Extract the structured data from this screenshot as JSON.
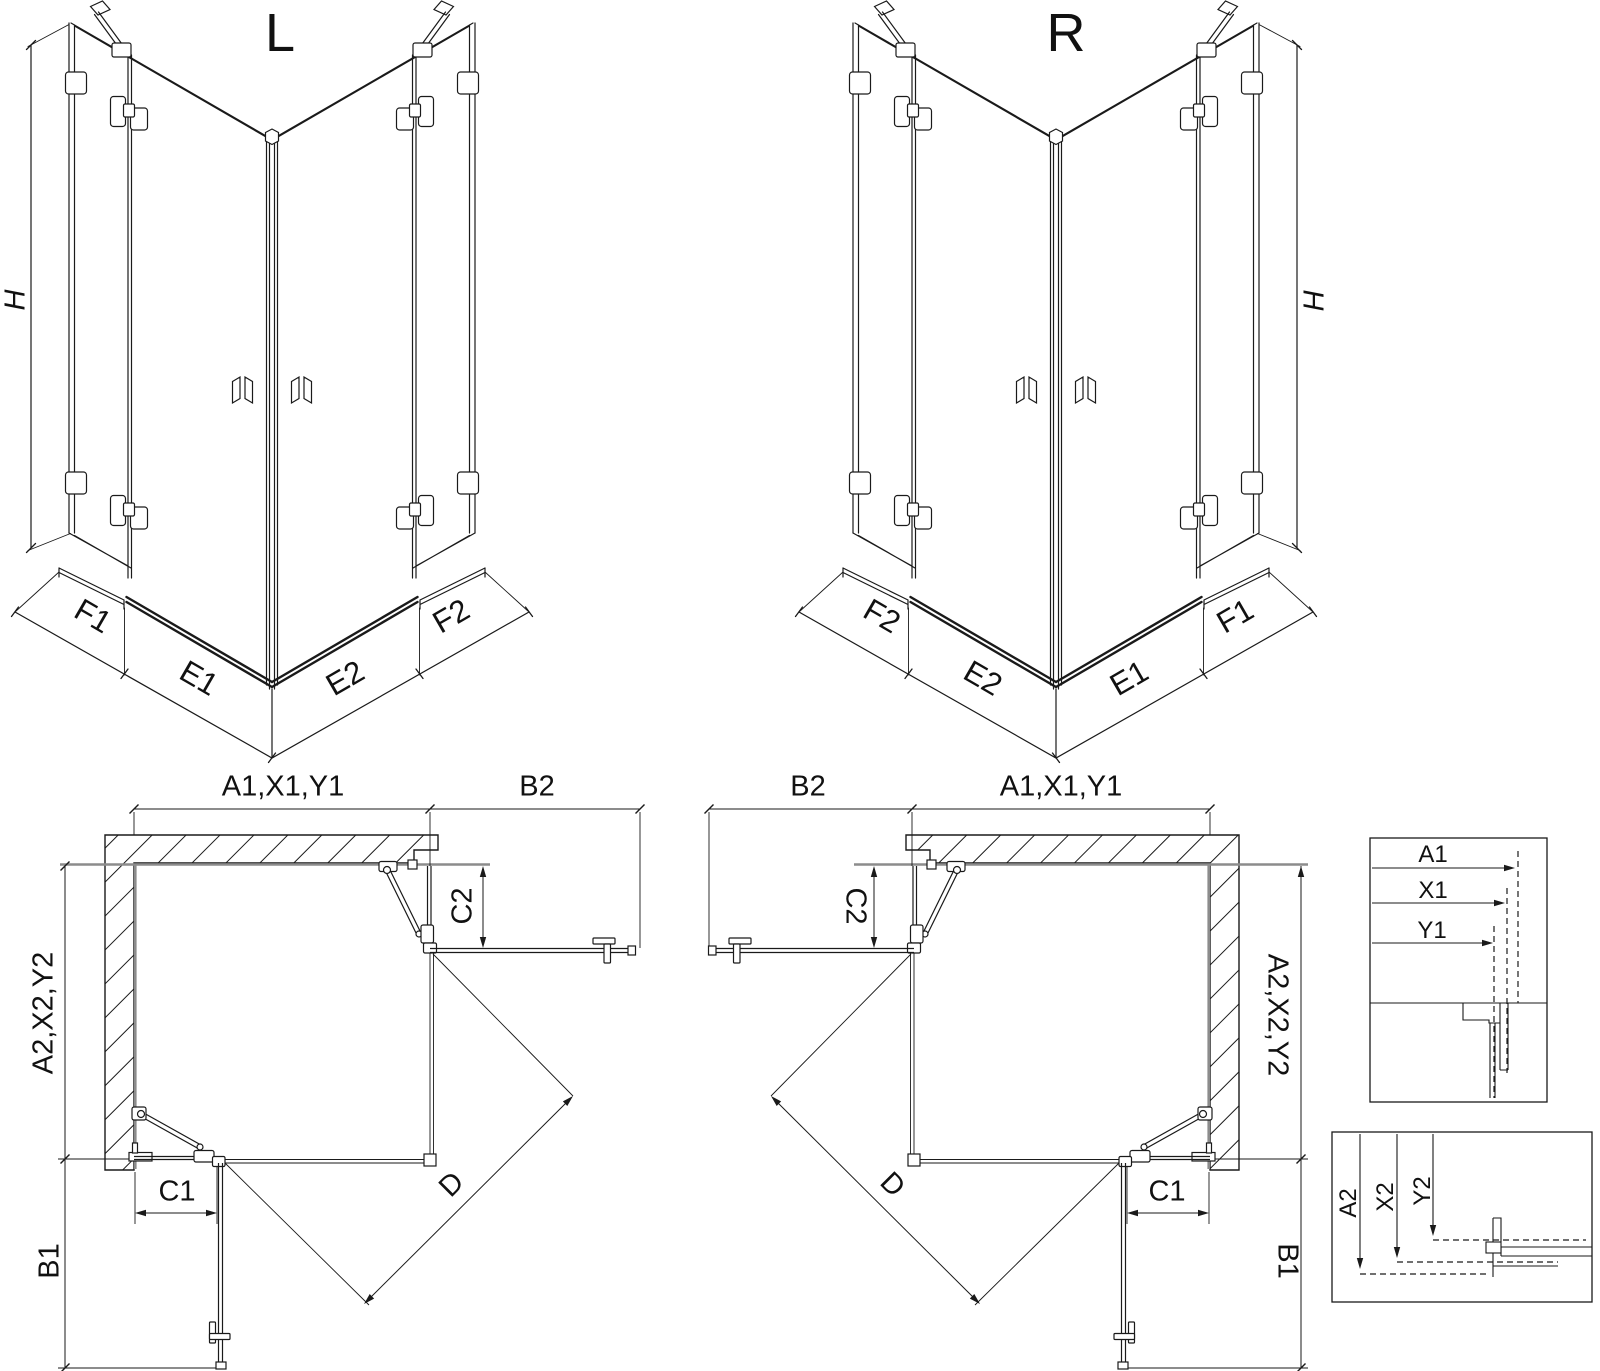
{
  "iso_left": {
    "title": "L",
    "height_dim": "H",
    "seg_front_left": "F1",
    "seg_bottom_left": "E1",
    "seg_bottom_right": "E2",
    "seg_front_right": "F2"
  },
  "iso_right": {
    "title": "R",
    "height_dim": "H",
    "seg_front_left": "F2",
    "seg_bottom_left": "E2",
    "seg_bottom_right": "E1",
    "seg_front_right": "F1"
  },
  "plan_left": {
    "dim_top": "A1,X1,Y1",
    "dim_top_right": "B2",
    "dim_left": "A2,X2,Y2",
    "dim_panel_right": "C2",
    "dim_panel_bottom": "C1",
    "dim_bottom_left": "B1",
    "dim_diagonal": "D"
  },
  "plan_right": {
    "dim_top": "A1,X1,Y1",
    "dim_top_left": "B2",
    "dim_right": "A2,X2,Y2",
    "dim_panel_left": "C2",
    "dim_panel_bottom": "C1",
    "dim_bottom_right": "B1",
    "dim_diagonal": "D"
  },
  "detail_glass_widths": {
    "dims": [
      "A1",
      "X1",
      "Y1"
    ]
  },
  "detail_glass_depths": {
    "dims": [
      "A2",
      "X2",
      "Y2"
    ]
  },
  "colors": {
    "line": "#1a1a1a",
    "wall_face": "#8c8c8c",
    "background": "#ffffff"
  }
}
